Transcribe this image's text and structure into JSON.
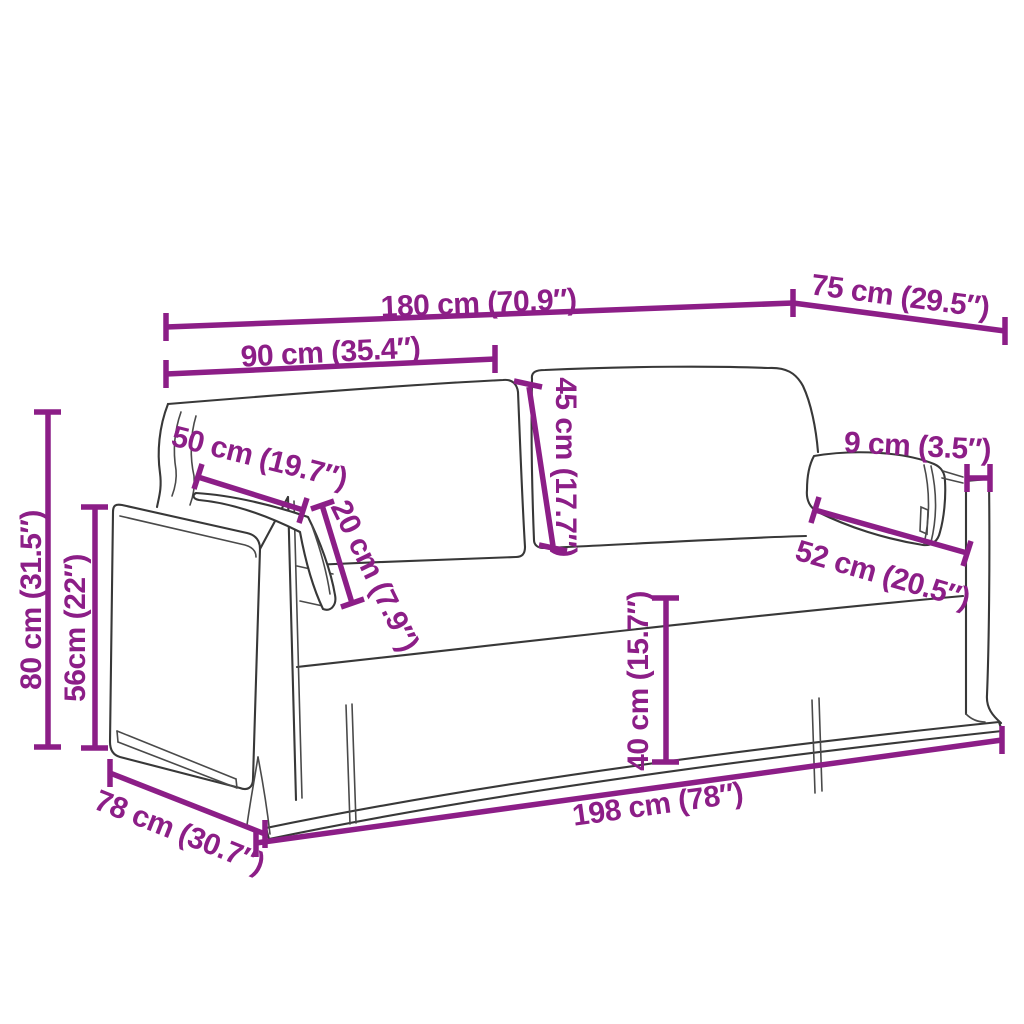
{
  "diagram": {
    "type": "product-dimension-diagram",
    "subject": "Line drawing of a two-seater slipcover sofa with two back cushions and two lumbar pillows, annotated with measurements",
    "background_color": "#ffffff",
    "sketch_color": "#383838",
    "accent_color": "#8C1E87",
    "unit_primary": "cm",
    "unit_secondary": "inches",
    "dimensions": [
      {
        "id": "back-width",
        "label": "180 cm (70.9″)"
      },
      {
        "id": "top-depth",
        "label": "75 cm (29.5″)"
      },
      {
        "id": "back-cushion-width",
        "label": "90 cm (35.4″)"
      },
      {
        "id": "back-cushion-height",
        "label": "45 cm (17.7″)"
      },
      {
        "id": "left-pillow-width",
        "label": "50 cm (19.7″)"
      },
      {
        "id": "left-pillow-height",
        "label": "20 cm (7.9″)"
      },
      {
        "id": "side-panel-thickness",
        "label": "9 cm (3.5″)"
      },
      {
        "id": "right-pillow-width",
        "label": "52 cm (20.5″)"
      },
      {
        "id": "overall-height",
        "label": "80 cm (31.5″)"
      },
      {
        "id": "arm-height",
        "label": "56cm (22″)"
      },
      {
        "id": "seat-height",
        "label": "40 cm (15.7″)"
      },
      {
        "id": "overall-width",
        "label": "198 cm (78″)"
      },
      {
        "id": "base-depth",
        "label": "78 cm (30.7″)"
      }
    ]
  }
}
